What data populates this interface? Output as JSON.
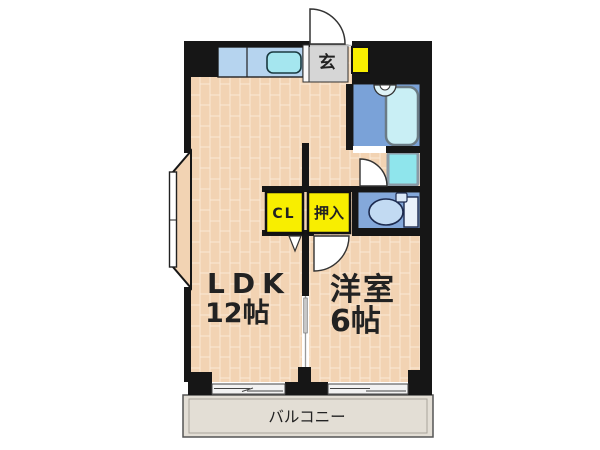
{
  "plan": {
    "type": "apartment-floor-plan",
    "rooms": [
      {
        "name": "LDK",
        "size": "12帖"
      },
      {
        "name": "洋室",
        "size": "6帖"
      },
      {
        "name": "玄関",
        "size": ""
      },
      {
        "name": "バルコニー",
        "size": ""
      }
    ]
  },
  "labels": {
    "genkan": "玄",
    "closet": "CL",
    "oshiire": "押入",
    "ldk_name": "LDK",
    "ldk_size": "12帖",
    "western_name": "洋室",
    "western_size": "6帖",
    "balcony": "バルコニー"
  },
  "colors": {
    "wall": "#161616",
    "floor_brick": "#f2d3b3",
    "floor_mortar": "#fbe8d6",
    "bay_floor": "#f2d3b3",
    "kitchen_counter": "#b6d4ef",
    "kitchen_sink": "#a5e6ef",
    "bath_floor": "#7aa2d8",
    "bathtub": "#c9eff5",
    "laundry_pan": "#8fe5ec",
    "toilet_floor": "#84a8da",
    "toilet_bowl": "#c2daf2",
    "toilet_tank": "#e9f1fa",
    "genkan_floor": "#d6d6d6",
    "storage_yellow": "#f8ee00",
    "balcony_floor": "#e3ded5",
    "window_glass": "#f2f2f2"
  }
}
